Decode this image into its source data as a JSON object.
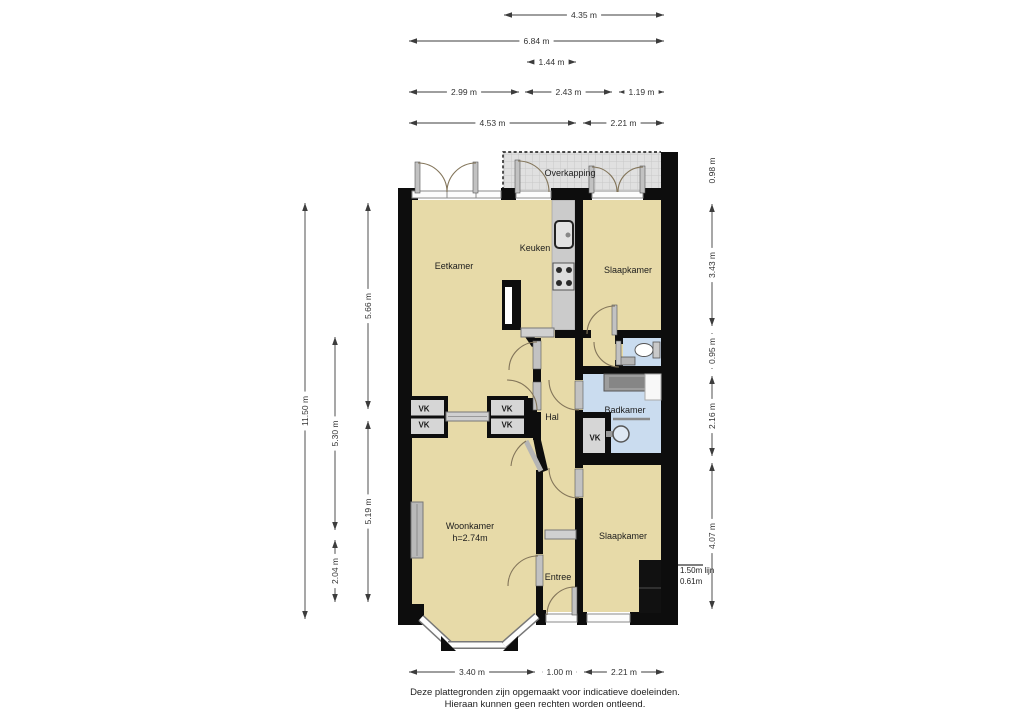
{
  "document": {
    "footer_line1": "Deze plattegronden zijn opgemaakt voor indicatieve doeleinden.",
    "footer_line2": "Hieraan kunnen geen rechten worden ontleend."
  },
  "floorplan": {
    "rooms": [
      {
        "id": "overkapping",
        "label": "Overkapping",
        "x": 570,
        "y": 173
      },
      {
        "id": "eetkamer",
        "label": "Eetkamer",
        "x": 454,
        "y": 266
      },
      {
        "id": "keuken",
        "label": "Keuken",
        "x": 535,
        "y": 248
      },
      {
        "id": "slaapkamer-1",
        "label": "Slaapkamer",
        "x": 628,
        "y": 270
      },
      {
        "id": "hal",
        "label": "Hal",
        "x": 552,
        "y": 417
      },
      {
        "id": "badkamer",
        "label": "Badkamer",
        "x": 625,
        "y": 410
      },
      {
        "id": "woonkamer",
        "label": "Woonkamer",
        "x": 470,
        "y": 526
      },
      {
        "id": "woonkamer-height",
        "label": "h=2.74m",
        "x": 470,
        "y": 538
      },
      {
        "id": "slaapkamer-2",
        "label": "Slaapkamer",
        "x": 623,
        "y": 536
      },
      {
        "id": "entree",
        "label": "Entree",
        "x": 558,
        "y": 577
      }
    ],
    "closets": [
      {
        "label": "VK",
        "x": 424,
        "y": 409
      },
      {
        "label": "VK",
        "x": 424,
        "y": 425
      },
      {
        "label": "VK",
        "x": 507,
        "y": 409
      },
      {
        "label": "VK",
        "x": 507,
        "y": 425
      },
      {
        "label": "VK",
        "x": 595,
        "y": 438
      }
    ],
    "annotation": {
      "line1": "1.50m lijn",
      "line2": "0.61m"
    },
    "fixture_icons": [
      "kitchen-sink-icon",
      "stove-icon",
      "chimney-icon",
      "radiator-icon",
      "washing-machine-icon",
      "shower-tray-icon",
      "washbasin-icon",
      "toilet-icon",
      "toilet-sink-icon",
      "bath-edge-line"
    ]
  },
  "dimensions": {
    "top": [
      {
        "label": "4.35 m",
        "x1": 503,
        "x2": 665,
        "y": 15
      },
      {
        "label": "6.84 m",
        "x1": 408,
        "x2": 665,
        "y": 41
      },
      {
        "label": "1.44 m",
        "x1": 526,
        "x2": 577,
        "y": 62
      },
      {
        "label": "2.99 m",
        "x1": 408,
        "x2": 520,
        "y": 92
      },
      {
        "label": "2.43 m",
        "x1": 524,
        "x2": 613,
        "y": 92
      },
      {
        "label": "1.19 m",
        "x1": 618,
        "x2": 665,
        "y": 92
      },
      {
        "label": "4.53 m",
        "x1": 408,
        "x2": 577,
        "y": 123
      },
      {
        "label": "2.21 m",
        "x1": 582,
        "x2": 665,
        "y": 123
      }
    ],
    "bottom": [
      {
        "label": "3.40 m",
        "x1": 408,
        "x2": 536,
        "y": 672
      },
      {
        "label": "1.00 m",
        "x1": 541,
        "x2": 578,
        "y": 672
      },
      {
        "label": "2.21 m",
        "x1": 583,
        "x2": 665,
        "y": 672
      }
    ],
    "left": [
      {
        "label": "11.50 m",
        "x": 305,
        "y1": 202,
        "y2": 620
      },
      {
        "label": "5.66 m",
        "x": 368,
        "y1": 202,
        "y2": 410
      },
      {
        "label": "5.30 m",
        "x": 335,
        "y1": 336,
        "y2": 531
      },
      {
        "label": "5.19 m",
        "x": 368,
        "y1": 420,
        "y2": 603
      },
      {
        "label": "2.04 m",
        "x": 335,
        "y1": 539,
        "y2": 603
      }
    ],
    "right": [
      {
        "label": "0.98 m",
        "x": 712,
        "y1": 153,
        "y2": 188
      },
      {
        "label": "3.43 m",
        "x": 712,
        "y1": 203,
        "y2": 327
      },
      {
        "label": "0.95 m",
        "x": 712,
        "y1": 332,
        "y2": 370
      },
      {
        "label": "2.16 m",
        "x": 712,
        "y1": 375,
        "y2": 457
      },
      {
        "label": "4.07 m",
        "x": 712,
        "y1": 462,
        "y2": 610
      }
    ]
  },
  "colors": {
    "floor": "#e7daa8",
    "wet_floor": "#cadcef",
    "counter": "#cbcbcb",
    "closet_floor": "#d6d6d6",
    "wall": "#0d0d0d",
    "canopy_fill": "#e0e0e0",
    "canopy_grid": "#c8c8c8",
    "dimension_line": "#3c3c3c"
  }
}
